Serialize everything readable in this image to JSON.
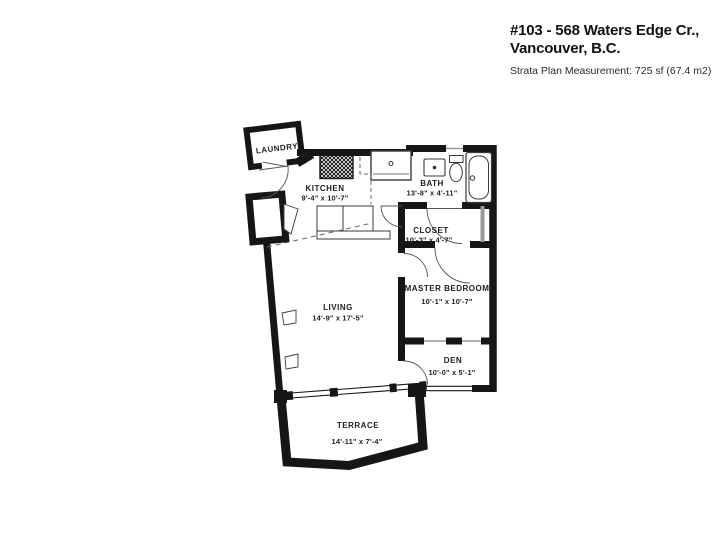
{
  "header": {
    "title_line1": "#103 - 568 Waters Edge Cr.,",
    "title_line2": "Vancouver, B.C.",
    "subtitle": "Strata Plan Measurement: 725 sf (67.4 m2)"
  },
  "floor_plan": {
    "rooms": [
      {
        "name": "LAUNDRY",
        "dimensions": ""
      },
      {
        "name": "KITCHEN",
        "dimensions": "9'-4\" x 10'-7\""
      },
      {
        "name": "BATH",
        "dimensions": "13'-8\" x 4'-11\""
      },
      {
        "name": "CLOSET",
        "dimensions": "10'-3\" x 4'-7\""
      },
      {
        "name": "MASTER BEDROOM",
        "dimensions": "10'-1\" x 10'-7\""
      },
      {
        "name": "DEN",
        "dimensions": "10'-0\" x 5'-1\""
      },
      {
        "name": "LIVING",
        "dimensions": "14'-9\" x 17'-5\""
      },
      {
        "name": "TERRACE",
        "dimensions": "14'-11\" x 7'-4\""
      }
    ],
    "fixtures": [
      "stove",
      "refrigerator",
      "kitchen-counter",
      "bath-sink",
      "toilet",
      "bathtub"
    ],
    "colors": {
      "wall": "#161616",
      "background": "#ffffff",
      "window": "#999999"
    }
  }
}
